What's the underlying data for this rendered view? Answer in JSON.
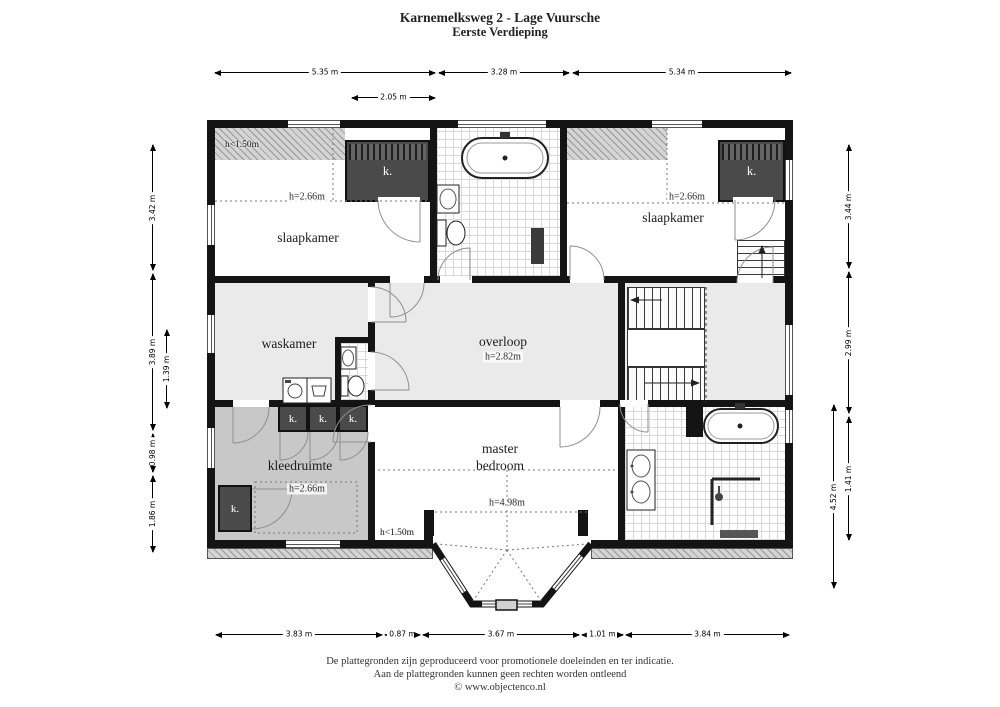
{
  "title": {
    "line1": "Karnemelksweg 2 - Lage Vuursche",
    "line2": "Eerste Verdieping"
  },
  "rooms": {
    "slaapkamer_left": {
      "name": "slaapkamer",
      "height": "h=2.66m"
    },
    "slaapkamer_right": {
      "name": "slaapkamer",
      "height": "h=2.66m"
    },
    "waskamer": {
      "name": "waskamer"
    },
    "overloop": {
      "name": "overloop",
      "height": "h=2.82m"
    },
    "kleedruimte": {
      "name": "kleedruimte",
      "height": "h=2.66m"
    },
    "master": {
      "name_line1": "master",
      "name_line2": "bedroom",
      "height": "h=4.98m"
    },
    "low_headroom": "h<1.50m",
    "closet": "k."
  },
  "dims": {
    "top": [
      "5.35 m",
      "3.28 m",
      "5.34 m"
    ],
    "top_inner": "2.05 m",
    "bottom": [
      "3.83 m",
      "0.87 m",
      "3.67 m",
      "1.01 m",
      "3.84 m"
    ],
    "left": [
      "3.42 m",
      "3.89 m",
      "0.98 m",
      "1.86 m"
    ],
    "left_inner": "1.39 m",
    "right": [
      "3.44 m",
      "2.99 m",
      "1.41 m"
    ],
    "right_outer": "4.52 m"
  },
  "footer": {
    "line1": "De plattegronden zijn geproduceerd voor promotionele doeleinden en ter indicatie.",
    "line2": "Aan de plattegronden kunnen geen rechten worden ontleend",
    "line3": "© www.objectenco.nl"
  },
  "colors": {
    "wall": "#141414",
    "closet_fill": "#4a4a4a",
    "floor_light": "#eaeaea",
    "floor_mid": "#c8c8c8",
    "hatch_base": "#d4d4d4"
  }
}
